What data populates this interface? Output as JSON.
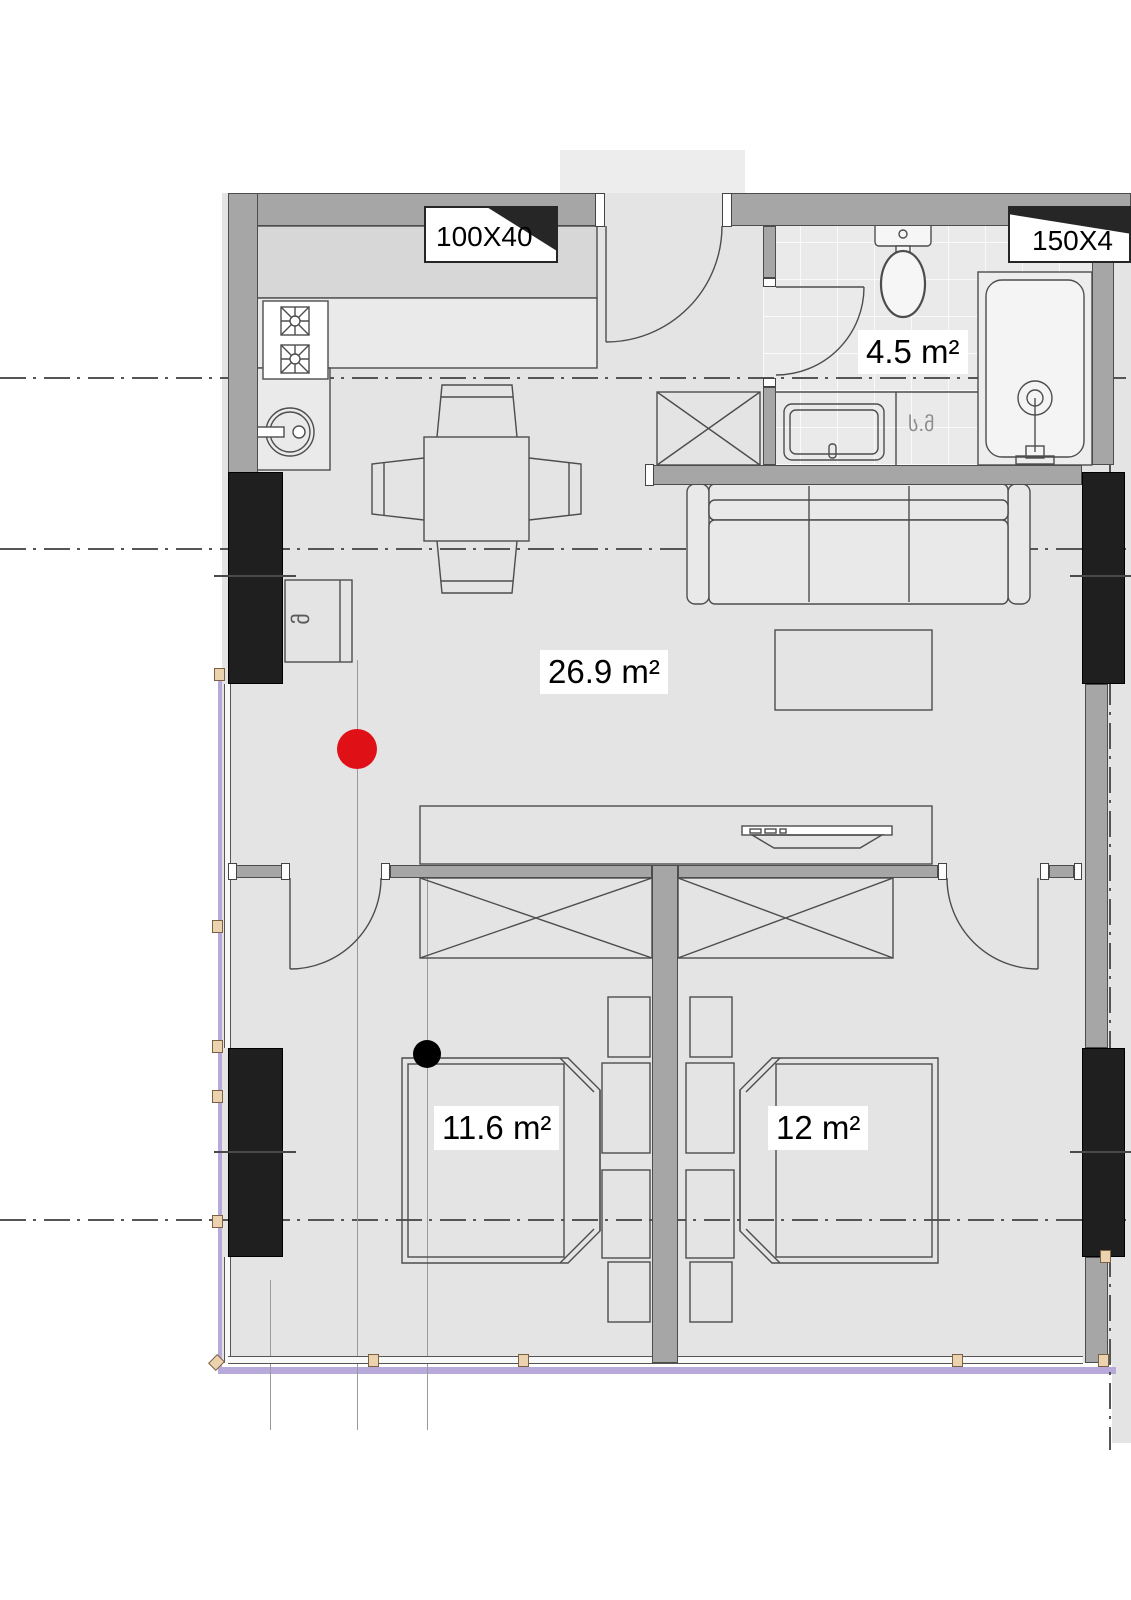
{
  "floor_plan": {
    "area_labels": [
      {
        "room": "living-kitchen",
        "text": "26.9 m²"
      },
      {
        "room": "bathroom",
        "text": "4.5 m²"
      },
      {
        "room": "bedroom-left",
        "text": "11.6 m²"
      },
      {
        "room": "bedroom-right",
        "text": "12 m²"
      }
    ],
    "opening_tags": [
      {
        "id": "kitchen-vent-window",
        "text": "100X40"
      },
      {
        "id": "bathroom-vent-window",
        "text": "150X4"
      }
    ],
    "fixture_labels": [
      {
        "id": "washing-machine",
        "text": "ს.მ"
      },
      {
        "id": "boiler",
        "text": "მ"
      }
    ],
    "markers": {
      "red_dot_color": "#df1117",
      "black_dot_color": "#000000"
    },
    "palette": {
      "wall_gray": "#a6a6a6",
      "column_black": "#1f1f1f",
      "floor_gray": "#e4e4e4",
      "boundary_lavender": "#b7a9da",
      "window_marker_tan": "#ecd3b0"
    }
  }
}
